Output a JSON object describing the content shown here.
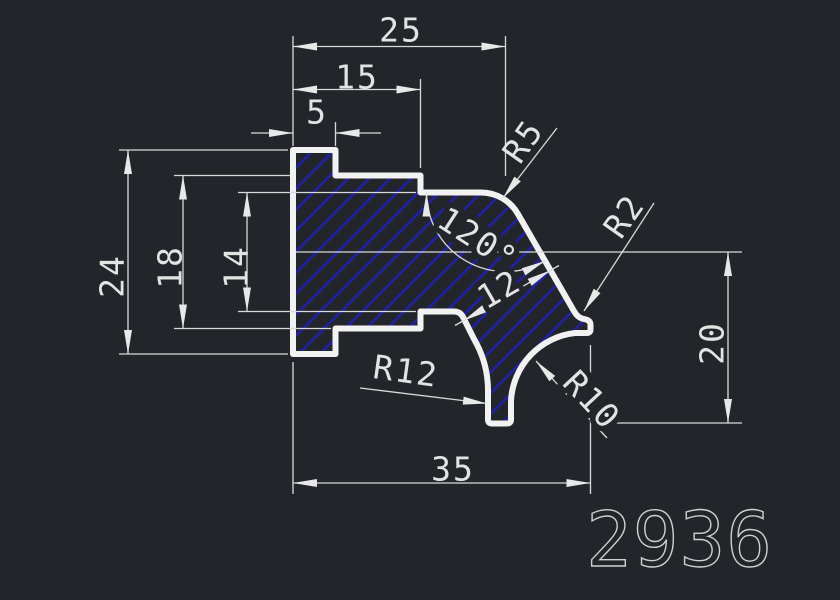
{
  "drawing": {
    "type": "cad-profile-cross-section",
    "part_number": "2936",
    "labels": {
      "dim_25": "25",
      "dim_15": "15",
      "dim_5": "5",
      "dim_24": "24",
      "dim_18": "18",
      "dim_14": "14",
      "dim_35": "35",
      "dim_20": "20",
      "dim_12": "12",
      "angle_120": "120°",
      "r5": "R5",
      "r2": "R2",
      "r10": "R10",
      "r12": "R12"
    },
    "colors": {
      "background": "#22262b",
      "outline": "#f2f2f2",
      "dimension_lines": "#d9d9d9",
      "hatch_blue": "#1f1fb4",
      "text": "#e3e3e3",
      "part_number_text": "#cfcfcf"
    }
  }
}
